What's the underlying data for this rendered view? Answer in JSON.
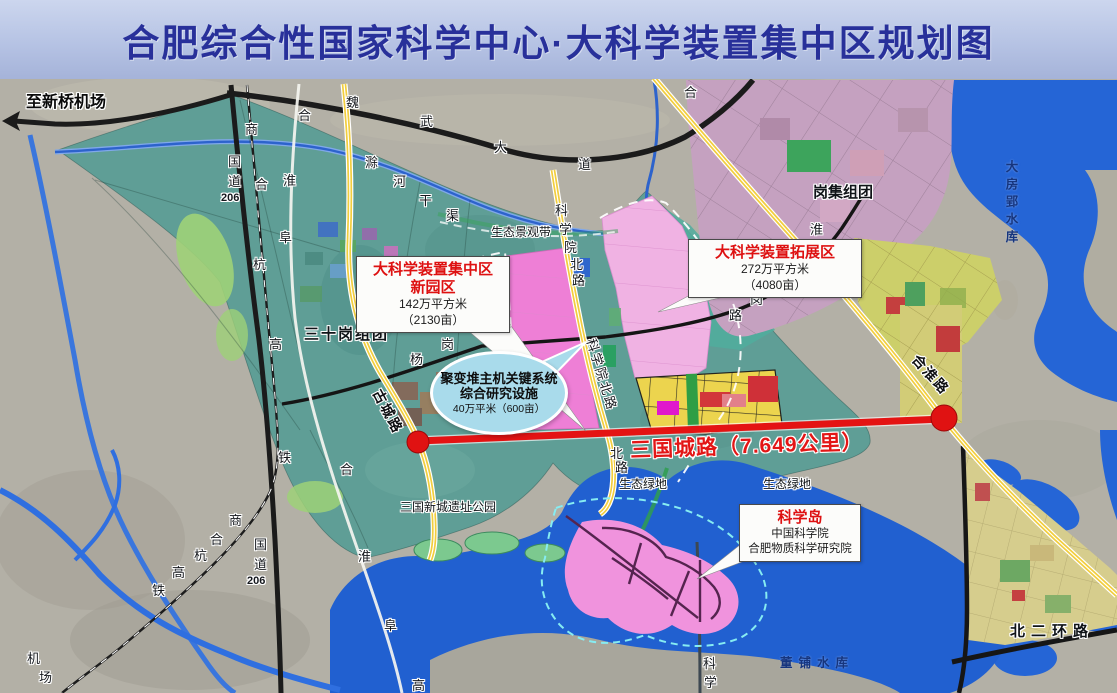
{
  "title": "合肥综合性国家科学中心·大科学装置集中区规划图",
  "road_banner": {
    "label": "三国城路（7.649公里）"
  },
  "callouts": {
    "new_park": {
      "title_line1": "大科学装置集中区",
      "title_line2": "新园区",
      "area": "142万平方米",
      "area_mu": "（2130亩）"
    },
    "expansion": {
      "title": "大科学装置拓展区",
      "area": "272万平方米",
      "area_mu": "（4080亩）"
    },
    "fusion": {
      "line1": "聚变堆主机关键系统",
      "line2": "综合研究设施",
      "area": "40万平米（600亩）"
    },
    "science_island": {
      "title": "科学岛",
      "line1": "中国科学院",
      "line2": "合肥物质科学研究院"
    }
  },
  "colors": {
    "title_bg": "#b6c3e4",
    "title_text": "#28309a",
    "land_gray": "#b3b0a6",
    "land_teal": "#5f9e96",
    "water_blue": "#2565d6",
    "road_yellow": "#f2ce3e",
    "road_black": "#1b1b1b",
    "expressway_white": "#f5f5f0",
    "red_road": "#e41313",
    "zone_pink_bright": "#ee7fd6",
    "zone_pink_light": "#f0b2e3",
    "zone_yellow_blocks": "#ecd44e",
    "urban_mauve": "#c5a1c0",
    "island_pink": "#f093dd",
    "callout_red": "#de1111",
    "fusion_ellipse": "#a9dbeb",
    "boundary_dash": "#ffffff",
    "island_dash": "#86ecf2",
    "greenway": "#2f9e50"
  },
  "map_labels": [
    {
      "t": "至新桥机场",
      "x": 26,
      "y": 95,
      "c": "dest halo"
    },
    {
      "t": "三十岗组团",
      "x": 304,
      "y": 327,
      "c": "region sp2 halo"
    },
    {
      "t": "岗集组团",
      "x": 813,
      "y": 185,
      "c": "region halo"
    },
    {
      "t": "北二环路",
      "x": 1010,
      "y": 624,
      "c": "region sp6 halo"
    },
    {
      "t": "生态景观带",
      "x": 491,
      "y": 226,
      "c": "small halo"
    },
    {
      "t": "生态绿地",
      "x": 619,
      "y": 478,
      "c": "small halo"
    },
    {
      "t": "生态绿地",
      "x": 763,
      "y": 478,
      "c": "small halo"
    },
    {
      "t": "三国新城遗址公园",
      "x": 400,
      "y": 501,
      "c": "small halo"
    },
    {
      "t": "大房郢水库",
      "x": 1004,
      "y": 160,
      "c": "wlabel",
      "v": true
    },
    {
      "t": "董铺水库",
      "x": 780,
      "y": 657,
      "c": "wlabel sp6"
    },
    {
      "t": "魏",
      "x": 346,
      "y": 96,
      "c": "rc halo"
    },
    {
      "t": "武",
      "x": 420,
      "y": 115,
      "c": "rc halo"
    },
    {
      "t": "大",
      "x": 494,
      "y": 141,
      "c": "rc halo"
    },
    {
      "t": "道",
      "x": 578,
      "y": 158,
      "c": "rc halo"
    },
    {
      "t": "滁",
      "x": 365,
      "y": 156,
      "c": "rc halo"
    },
    {
      "t": "河",
      "x": 393,
      "y": 175,
      "c": "rc halo"
    },
    {
      "t": "干",
      "x": 419,
      "y": 194,
      "c": "rc halo"
    },
    {
      "t": "渠",
      "x": 446,
      "y": 209,
      "c": "rc halo"
    },
    {
      "t": "国",
      "x": 228,
      "y": 155,
      "c": "rc halo"
    },
    {
      "t": "道",
      "x": 228,
      "y": 175,
      "c": "rc halo"
    },
    {
      "t": "206",
      "x": 221,
      "y": 193,
      "c": "rc206 halo"
    },
    {
      "t": "商",
      "x": 245,
      "y": 123,
      "c": "rc halo"
    },
    {
      "t": "合",
      "x": 255,
      "y": 178,
      "c": "rc halo"
    },
    {
      "t": "杭",
      "x": 253,
      "y": 258,
      "c": "rc halo"
    },
    {
      "t": "高",
      "x": 269,
      "y": 338,
      "c": "rc halo"
    },
    {
      "t": "铁",
      "x": 278,
      "y": 451,
      "c": "rc halo"
    },
    {
      "t": "合",
      "x": 298,
      "y": 109,
      "c": "rc halo"
    },
    {
      "t": "淮",
      "x": 283,
      "y": 174,
      "c": "rc halo"
    },
    {
      "t": "阜",
      "x": 279,
      "y": 231,
      "c": "rc halo"
    },
    {
      "t": "科",
      "x": 555,
      "y": 204,
      "c": "rc halo"
    },
    {
      "t": "学",
      "x": 559,
      "y": 223,
      "c": "rc halo"
    },
    {
      "t": "院",
      "x": 564,
      "y": 241,
      "c": "rc halo"
    },
    {
      "t": "北",
      "x": 570,
      "y": 258,
      "c": "rc halo"
    },
    {
      "t": "路",
      "x": 572,
      "y": 274,
      "c": "rc halo"
    },
    {
      "t": "合",
      "x": 684,
      "y": 86,
      "c": "rc halo"
    },
    {
      "t": "淮",
      "x": 810,
      "y": 223,
      "c": "rc halo"
    },
    {
      "t": "杨",
      "x": 774,
      "y": 276,
      "c": "rc halo"
    },
    {
      "t": "岗",
      "x": 750,
      "y": 293,
      "c": "rc halo"
    },
    {
      "t": "路",
      "x": 729,
      "y": 309,
      "c": "rc halo"
    },
    {
      "t": "杨",
      "x": 410,
      "y": 353,
      "c": "rc halo"
    },
    {
      "t": "岗",
      "x": 441,
      "y": 338,
      "c": "rc halo"
    },
    {
      "t": "路",
      "x": 498,
      "y": 320,
      "c": "rc halo"
    },
    {
      "t": "北",
      "x": 610,
      "y": 447,
      "c": "rc halo"
    },
    {
      "t": "路",
      "x": 615,
      "y": 461,
      "c": "rc halo"
    },
    {
      "t": "商",
      "x": 229,
      "y": 514,
      "c": "rc halo"
    },
    {
      "t": "合",
      "x": 210,
      "y": 533,
      "c": "rc halo"
    },
    {
      "t": "杭",
      "x": 194,
      "y": 549,
      "c": "rc halo"
    },
    {
      "t": "高",
      "x": 172,
      "y": 566,
      "c": "rc halo"
    },
    {
      "t": "铁",
      "x": 152,
      "y": 584,
      "c": "rc halo"
    },
    {
      "t": "国",
      "x": 254,
      "y": 538,
      "c": "rc halo"
    },
    {
      "t": "道",
      "x": 254,
      "y": 558,
      "c": "rc halo"
    },
    {
      "t": "206",
      "x": 247,
      "y": 576,
      "c": "rc206 halo"
    },
    {
      "t": "合",
      "x": 340,
      "y": 463,
      "c": "rc halo"
    },
    {
      "t": "淮",
      "x": 358,
      "y": 550,
      "c": "rc halo"
    },
    {
      "t": "阜",
      "x": 384,
      "y": 619,
      "c": "rc halo"
    },
    {
      "t": "高",
      "x": 412,
      "y": 679,
      "c": "rc halo"
    },
    {
      "t": "机",
      "x": 27,
      "y": 652,
      "c": "rc halo"
    },
    {
      "t": "场",
      "x": 39,
      "y": 671,
      "c": "rc halo"
    },
    {
      "t": "科",
      "x": 703,
      "y": 657,
      "c": "rc halo"
    },
    {
      "t": "学",
      "x": 704,
      "y": 676,
      "c": "rc halo"
    },
    {
      "t": "古城路",
      "x": 383,
      "y": 387,
      "c": "rrotb halo",
      "r": 62
    },
    {
      "t": "科学院北路",
      "x": 597,
      "y": 337,
      "c": "rrot halo",
      "r": 73
    },
    {
      "t": "合淮路",
      "x": 920,
      "y": 352,
      "c": "rrotb halo",
      "r": 48
    }
  ]
}
